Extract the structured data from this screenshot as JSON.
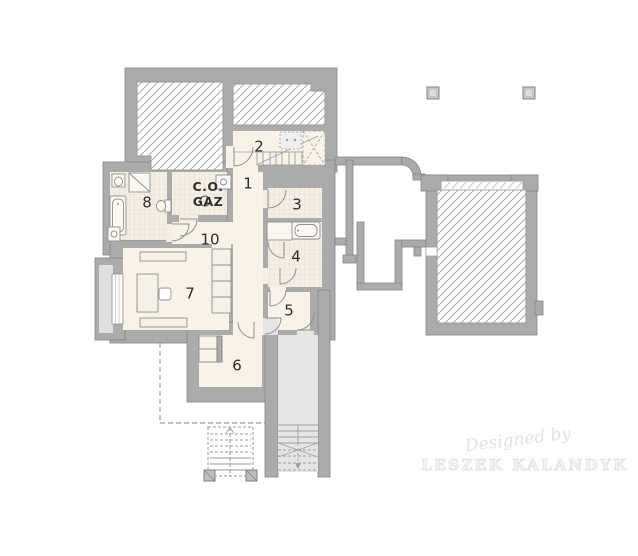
{
  "plan": {
    "title": "basement floor plan",
    "rooms": [
      {
        "id": "room-1",
        "number": "1"
      },
      {
        "id": "room-2",
        "number": "2"
      },
      {
        "id": "room-3",
        "number": "3"
      },
      {
        "id": "room-4",
        "number": "4"
      },
      {
        "id": "room-5",
        "number": "5"
      },
      {
        "id": "room-6",
        "number": "6"
      },
      {
        "id": "room-7",
        "number": "7"
      },
      {
        "id": "room-8",
        "number": "8"
      },
      {
        "id": "room-10",
        "number": "10"
      }
    ],
    "boiler_room": {
      "line1": "C.O.",
      "line2": "GAZ"
    },
    "watermark": {
      "credit": "Designed by",
      "author": "LESZEK KALANDYK"
    },
    "fixtures": [
      "staircase",
      "boiler",
      "bathtub",
      "shower",
      "toilet",
      "sink",
      "desk",
      "chair",
      "shelf",
      "wardrobe",
      "garage",
      "pillar",
      "exterior-stairs",
      "window-well",
      "window"
    ],
    "colors": {
      "wall": "#ababab",
      "wall_edge": "#858585",
      "floor_cream": "#f8f2e7",
      "floor_tile": "#f4eee3",
      "tile_grid": "#e3d5cb",
      "hatch_line": "#aeaeae",
      "stair_floor": "#e5e5e5",
      "dashed_line": "#9a9a9a",
      "label_text": "#2d2d2d",
      "watermark_text": "#e2e2e2",
      "background": "#ffffff"
    }
  }
}
